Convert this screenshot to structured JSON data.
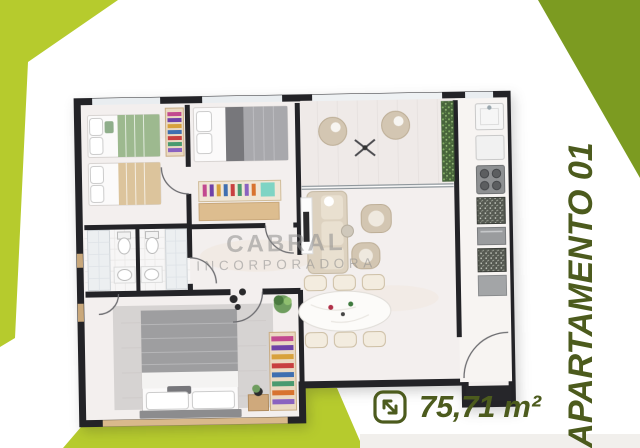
{
  "branding": {
    "watermark_line1": "CABRAL",
    "watermark_line2": "INCORPORADORA"
  },
  "labels": {
    "apartment_name": "APARTAMENTO 01",
    "area_value": "75,71 m²"
  },
  "icons": {
    "area_icon": "expand-diagonal-arrow"
  },
  "colors": {
    "lime_green": "#b6cb2d",
    "olive_green": "#7c9b21",
    "label_green": "#4c5b1d",
    "wall_dark": "#232327",
    "floor_light": "#f3efee",
    "watermark_gray": "#8c8c8c"
  }
}
